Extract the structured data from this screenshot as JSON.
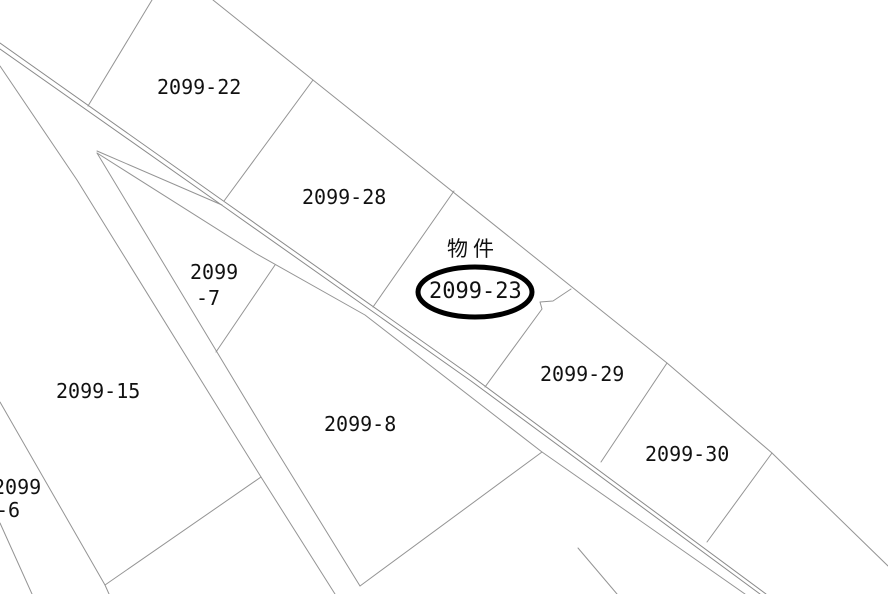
{
  "map": {
    "type": "cadastral-parcel-map",
    "background_color": "#ffffff",
    "boundary_line_color": "#949494",
    "road_line_color": "#8a8a8a",
    "highlight_color": "#000000",
    "property_marker_label": "物件",
    "highlighted_parcel": "2099-23",
    "labels": {
      "lot22": "2099-22",
      "lot28": "2099-28",
      "bukken": "物件",
      "lot23": "2099-23",
      "lot29": "2099-29",
      "lot30": "2099-30",
      "lot15": "2099-15",
      "lot8": "2099-8",
      "lot7_line1": "2099",
      "lot7_line2": "-7",
      "lot6_line1": "2099",
      "lot6_line2": "-6"
    },
    "parcels": [
      {
        "id": "2099-22"
      },
      {
        "id": "2099-28"
      },
      {
        "id": "2099-23",
        "note": "物件 (subject property, circled)"
      },
      {
        "id": "2099-29"
      },
      {
        "id": "2099-30"
      },
      {
        "id": "2099-15"
      },
      {
        "id": "2099-8"
      },
      {
        "id": "2099-7"
      },
      {
        "id": "2099-6"
      }
    ]
  }
}
